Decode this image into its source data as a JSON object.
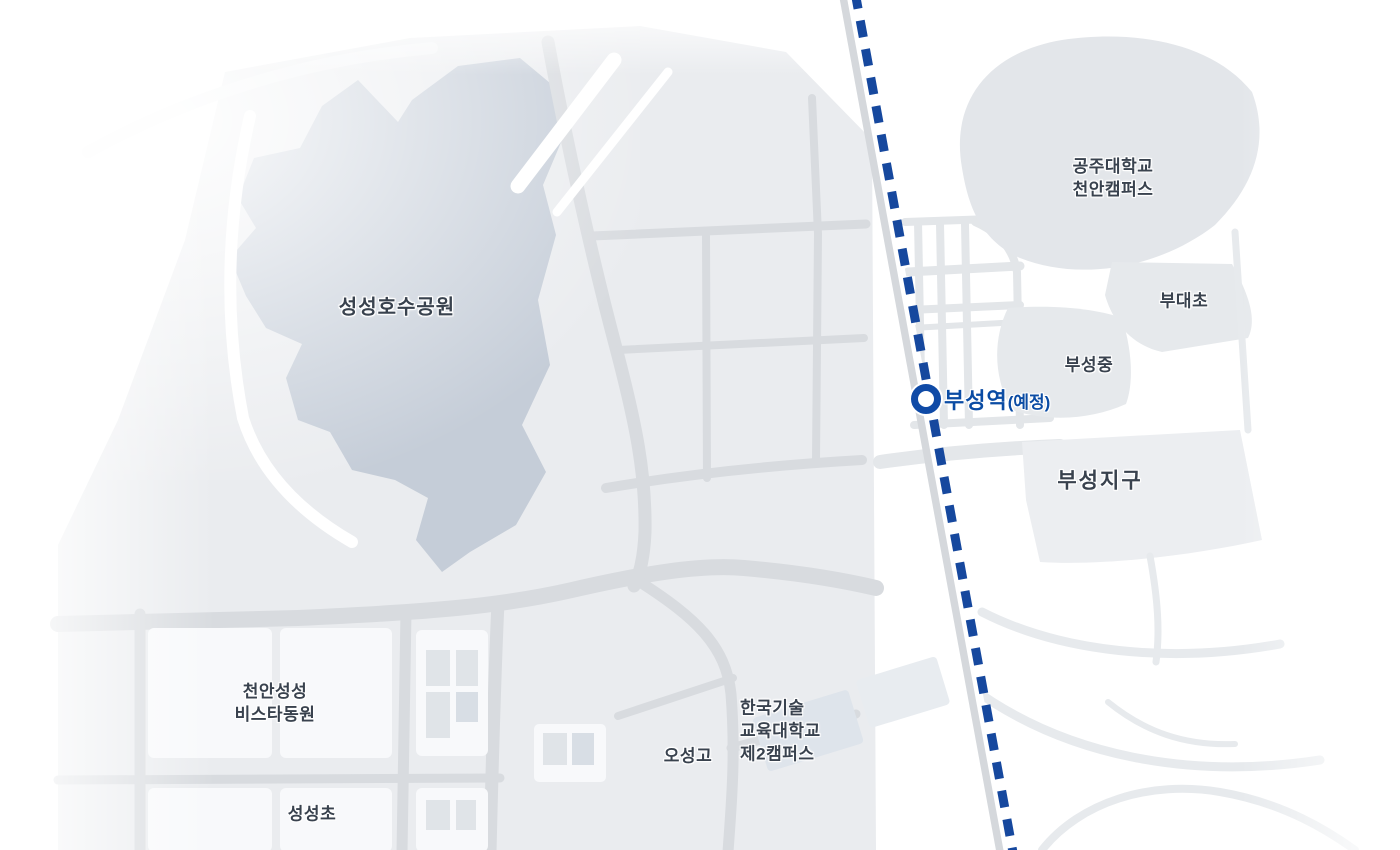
{
  "map": {
    "kind": "static-area-map",
    "labels": {
      "lake_park": "성성호수공원",
      "university_line1": "공주대학교",
      "university_line2": "천안캠퍼스",
      "budae_elementary": "부대초",
      "buseong_middle": "부성중",
      "buseong_district": "부성지구",
      "vista_line1": "천안성성",
      "vista_line2": "비스타동원",
      "seongseong_elementary": "성성초",
      "oseong_high": "오성고",
      "koreatech_line1": "한국기술",
      "koreatech_line2": "교육대학교",
      "koreatech_line3": "제2캠퍼스"
    },
    "station": {
      "name": "부성역",
      "status": "(예정)"
    },
    "railway": {
      "style": "dashed",
      "color": "#16489E"
    },
    "colors": {
      "lake_fill": "#C5CDD8",
      "label_text": "#39424E",
      "station_blue": "#0B4CA4",
      "road_gray": "#D8DBDF",
      "urban_block": "#EAECEF",
      "campus_gray": "#E3E6EA"
    }
  }
}
